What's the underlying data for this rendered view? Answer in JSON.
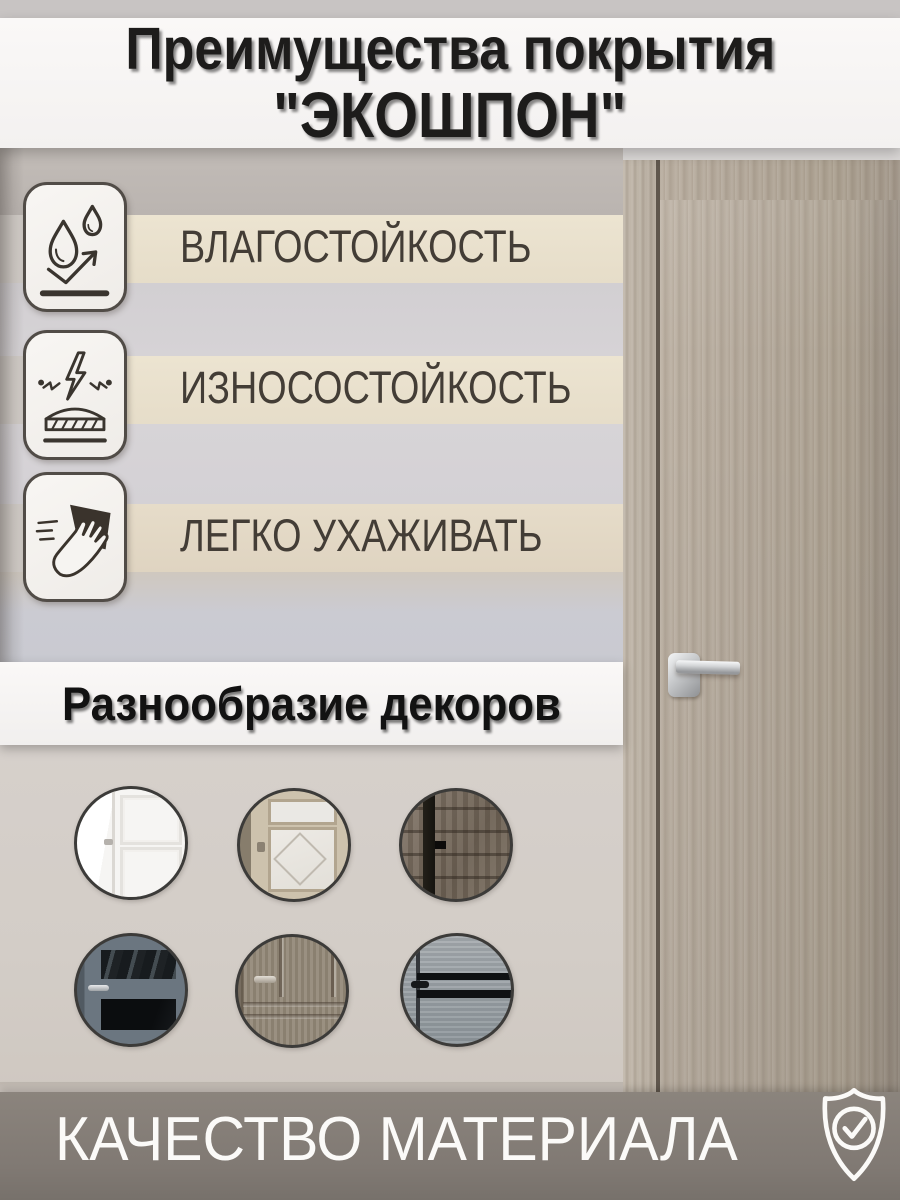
{
  "title": {
    "line1": "Преимущества покрытия",
    "line2": "\"ЭКОШПОН\""
  },
  "features": [
    {
      "label": "ВЛАГОСТОЙКОСТЬ",
      "icon": "water-drops-icon"
    },
    {
      "label": "ИЗНОСОСТОЙКОСТЬ",
      "icon": "impact-resistance-icon"
    },
    {
      "label": "ЛЕГКО УХАЖИВАТЬ",
      "icon": "easy-clean-icon"
    }
  ],
  "decors": {
    "heading": "Разнообразие декоров",
    "items": [
      {
        "name": "white-classic-door"
      },
      {
        "name": "oak-door-with-decorative-glass"
      },
      {
        "name": "dark-rustic-wood-door"
      },
      {
        "name": "blue-gray-door-with-dark-glass"
      },
      {
        "name": "walnut-classic-door"
      },
      {
        "name": "gray-loft-door-with-black-glass-strips"
      }
    ]
  },
  "footer": {
    "label": "КАЧЕСТВО МАТЕРИАЛА",
    "icon": "shield-check-icon"
  },
  "colors": {
    "stripe_beige": "#e9e1ce",
    "banner_white": "#f7f5f4",
    "footer_bar": "#807973",
    "text_dark": "#433d36",
    "door_wood": "#b0a597"
  }
}
